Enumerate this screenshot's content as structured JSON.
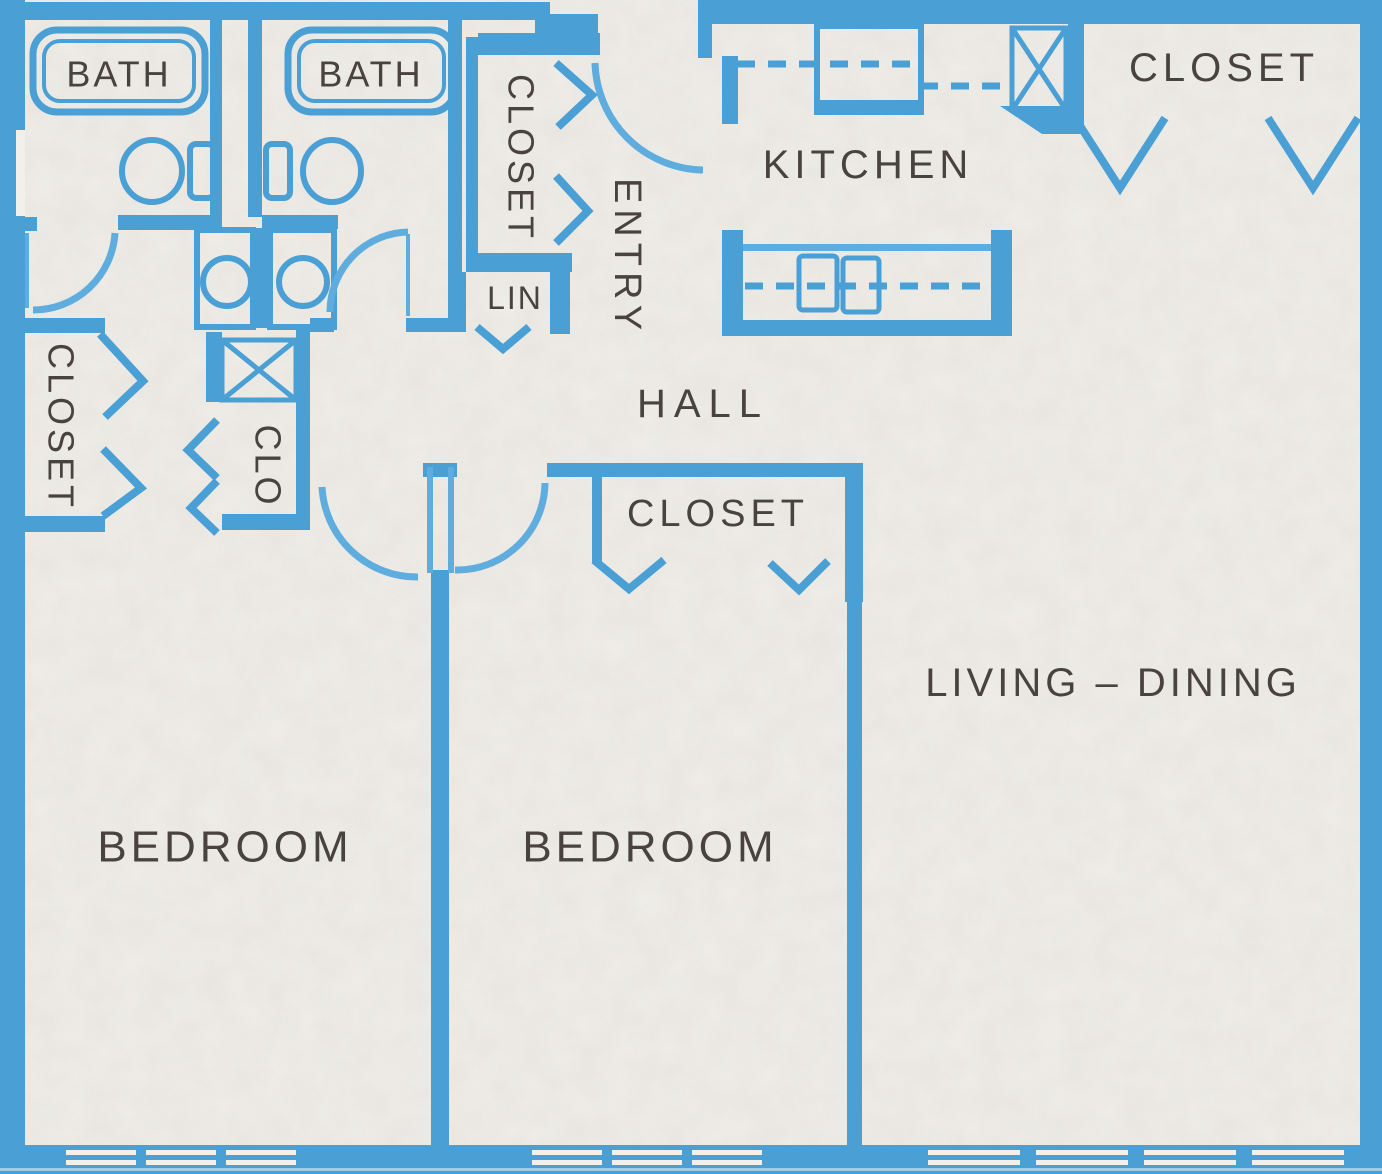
{
  "title": "Apartment floor plan",
  "palette": {
    "wall_blue": "#4aa0d5",
    "wall_blue_light": "#5fadde",
    "paper": "#f2f0eb",
    "label_ink": "#49433d"
  },
  "rooms": {
    "bath_1": "BATH",
    "bath_2": "BATH",
    "entry_closet": "CLOSET",
    "linen_closet": "LIN",
    "entry": "ENTRY",
    "kitchen": "KITCHEN",
    "kitchen_closet": "CLOSET",
    "hall": "HALL",
    "bedroom_1_closet": "CLOSET",
    "clo_closet": "CLO",
    "bedroom_2_closet": "CLOSET",
    "living_dining": "LIVING – DINING",
    "bedroom_1": "BEDROOM",
    "bedroom_2": "BEDROOM"
  },
  "fixtures": [
    "bathtub",
    "toilet",
    "sink-vanity",
    "kitchen-counter",
    "kitchen-sink",
    "upper-cabinet-dashed-line",
    "appliance-box",
    "utility-x-box",
    "bifold-door-chevron",
    "swing-door-arc",
    "window-slits"
  ]
}
